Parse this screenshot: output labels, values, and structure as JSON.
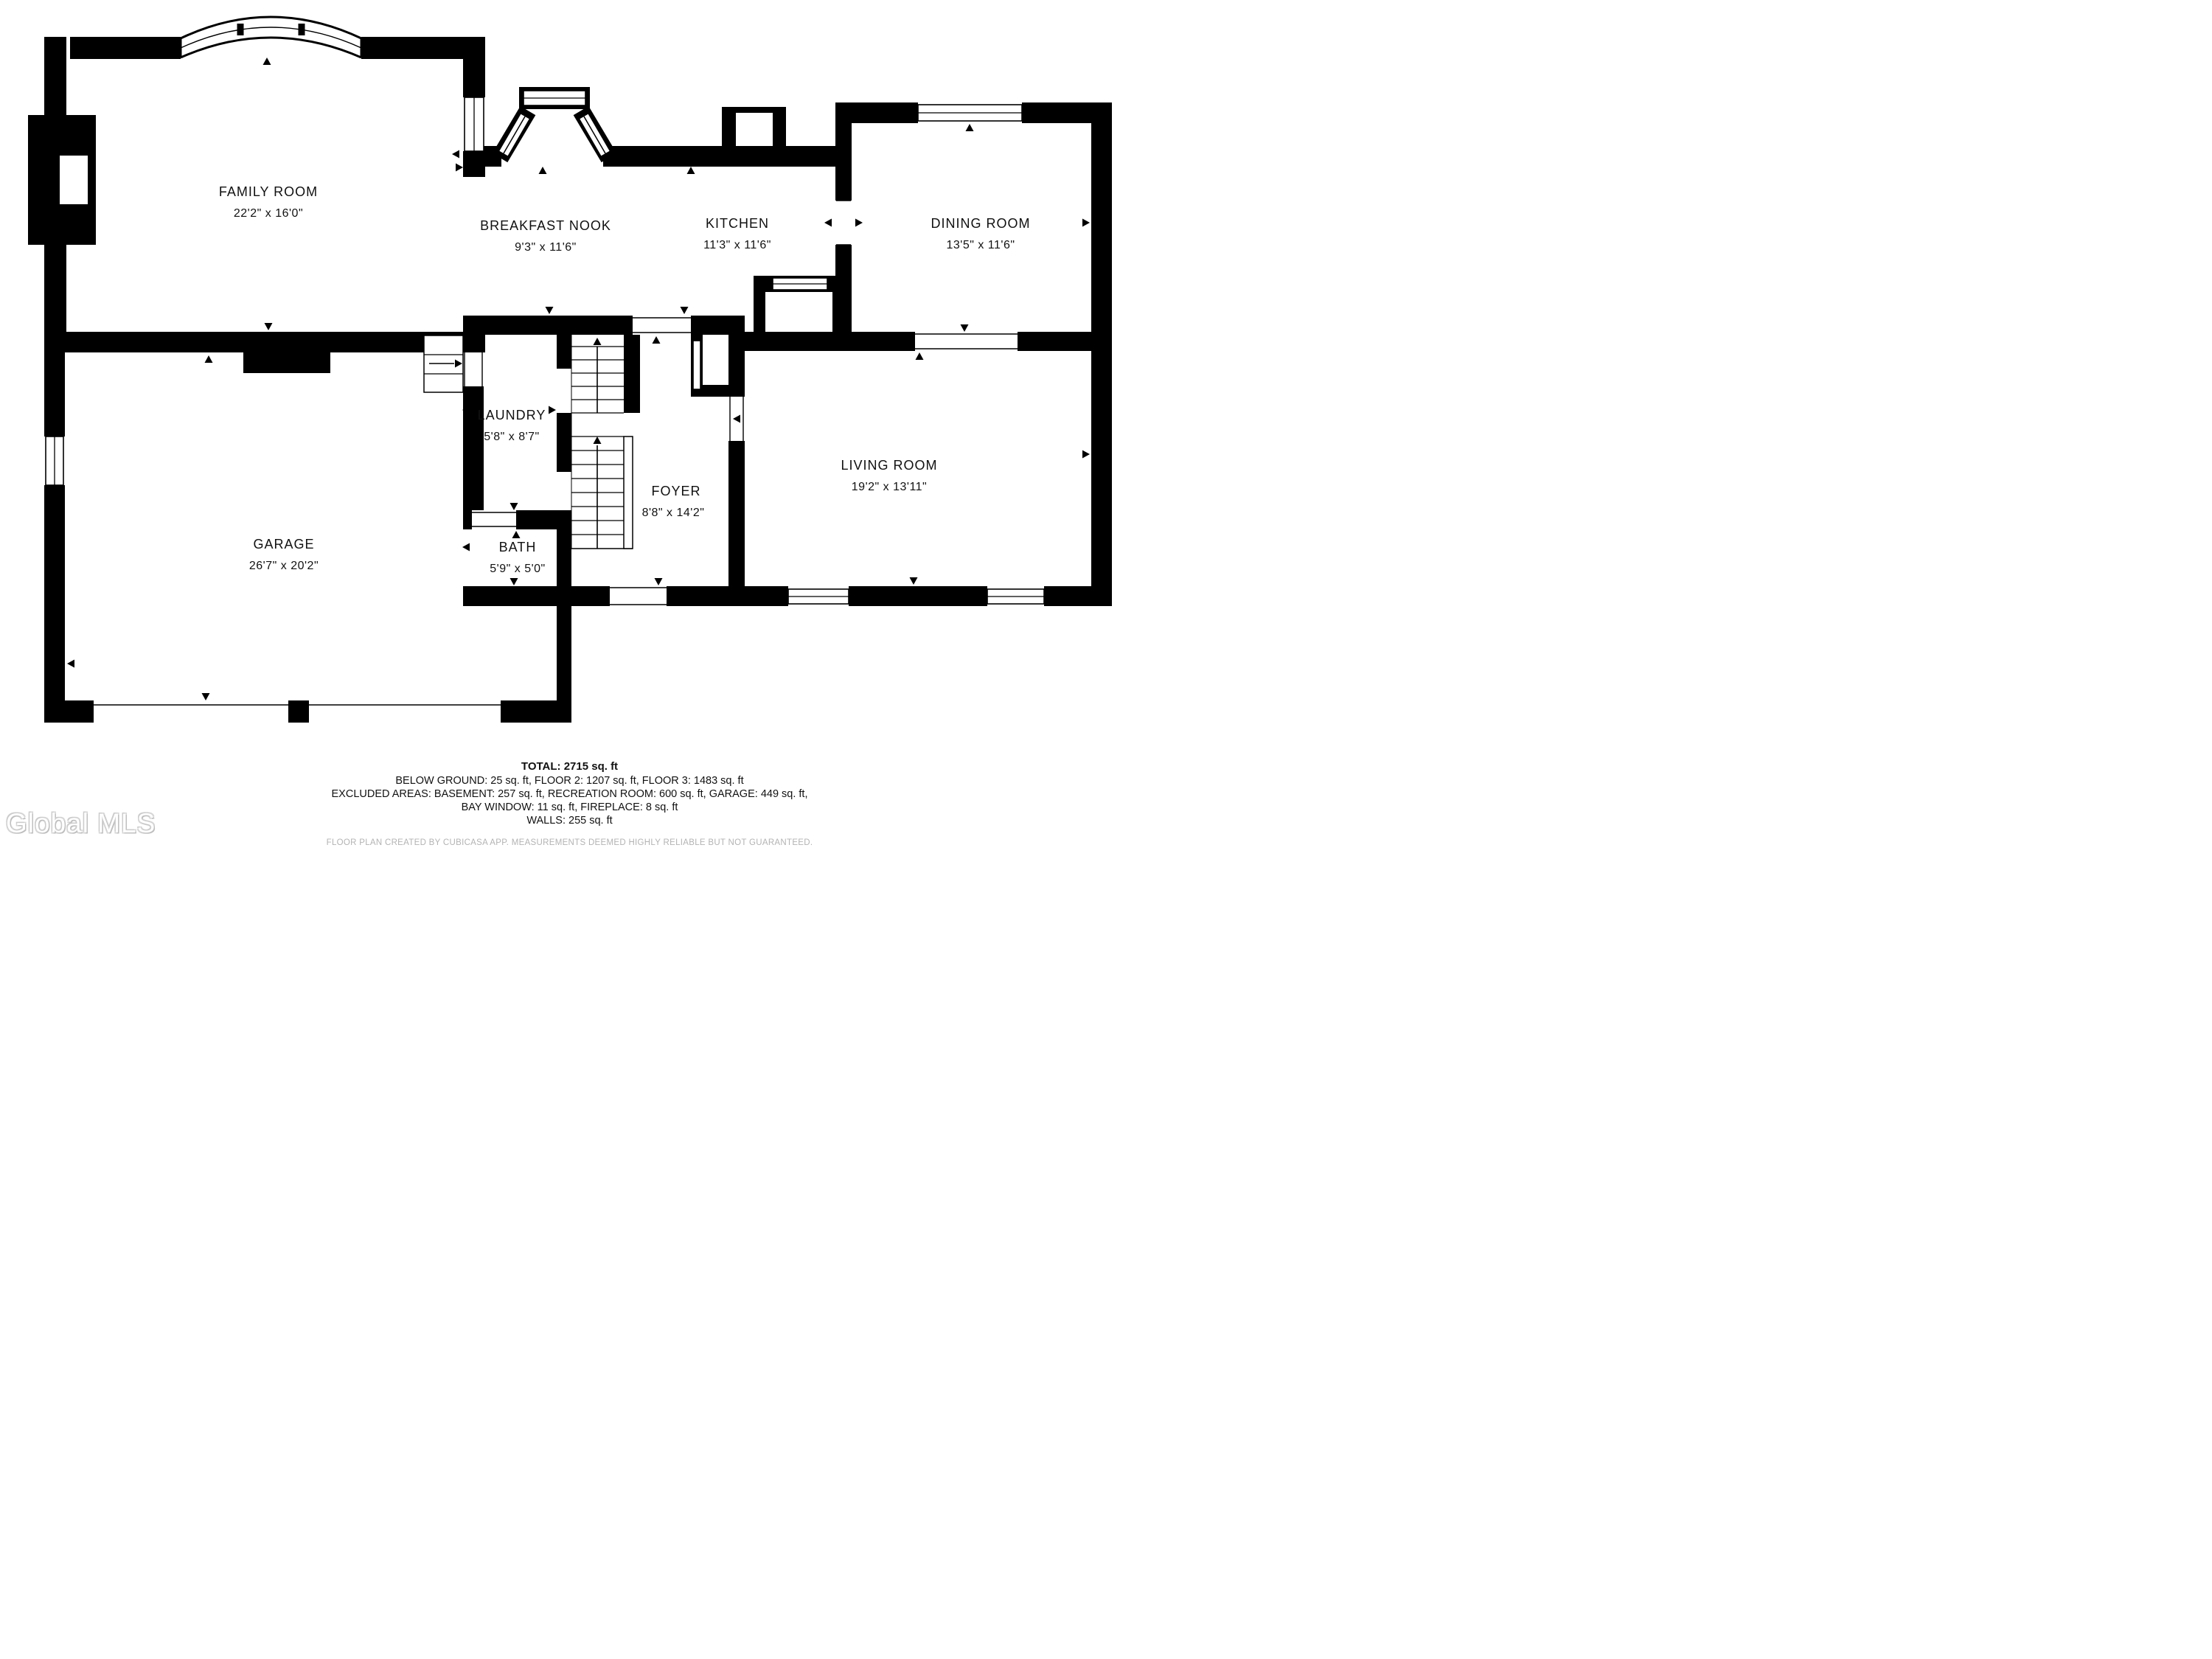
{
  "plan": {
    "rooms": [
      {
        "id": "family-room",
        "name": "FAMILY ROOM",
        "dims": "22'2\" x 16'0\""
      },
      {
        "id": "breakfast-nook",
        "name": "BREAKFAST NOOK",
        "dims": "9'3\" x 11'6\""
      },
      {
        "id": "kitchen",
        "name": "KITCHEN",
        "dims": "11'3\" x 11'6\""
      },
      {
        "id": "dining-room",
        "name": "DINING ROOM",
        "dims": "13'5\" x 11'6\""
      },
      {
        "id": "laundry",
        "name": "LAUNDRY",
        "dims": "5'8\" x 8'7\""
      },
      {
        "id": "foyer",
        "name": "FOYER",
        "dims": "8'8\" x 14'2\""
      },
      {
        "id": "garage",
        "name": "GARAGE",
        "dims": "26'7\" x 20'2\""
      },
      {
        "id": "bath",
        "name": "BATH",
        "dims": "5'9\" x 5'0\""
      },
      {
        "id": "living-room",
        "name": "LIVING ROOM",
        "dims": "19'2\" x 13'11\""
      }
    ],
    "features": [
      "bay-window",
      "fireplace",
      "stairs-up",
      "garage-steps"
    ]
  },
  "footer": {
    "total": "TOTAL: 2715 sq. ft",
    "line2": "BELOW GROUND: 25 sq. ft, FLOOR 2: 1207 sq. ft, FLOOR 3: 1483 sq. ft",
    "line3": "EXCLUDED AREAS: BASEMENT: 257 sq. ft, RECREATION ROOM: 600 sq. ft, GARAGE: 449 sq. ft,",
    "line4": "BAY WINDOW: 11 sq. ft, FIREPLACE: 8 sq. ft",
    "line5": "WALLS: 255 sq. ft",
    "disclaimer": "FLOOR PLAN CREATED BY CUBICASA APP. MEASUREMENTS DEEMED HIGHLY RELIABLE BUT NOT GUARANTEED."
  },
  "watermark": "Global MLS",
  "colors": {
    "wall": "#000000",
    "background": "#ffffff",
    "disclaimer_text": "#b3b3b3",
    "watermark_shadow": "#c7c7c7"
  }
}
